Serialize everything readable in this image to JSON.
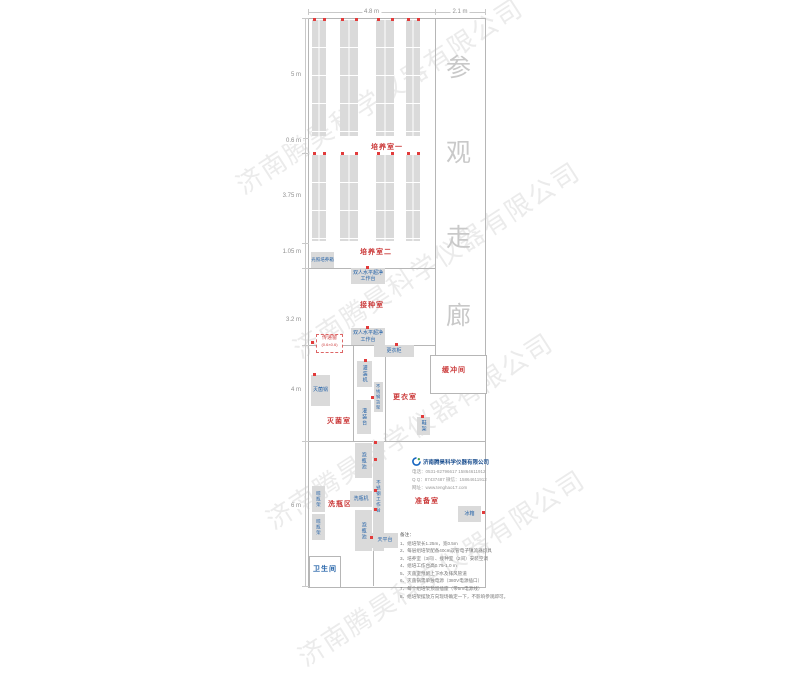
{
  "watermark": {
    "text": "济南腾昊科学仪器有限公司",
    "positions": [
      [
        238,
        168
      ],
      [
        295,
        332
      ],
      [
        268,
        503
      ],
      [
        300,
        640
      ]
    ]
  },
  "corridor": {
    "label": "参观走廊",
    "x": 446,
    "char_ys": [
      48,
      133,
      218,
      296
    ]
  },
  "dimensions": {
    "top": [
      {
        "label": "4.8 m",
        "x1": 308,
        "x2": 435
      },
      {
        "label": "2.1 m",
        "x1": 435,
        "x2": 485
      }
    ],
    "left": [
      {
        "label": "5 m",
        "y": 75
      },
      {
        "label": "0.6 m",
        "y": 141
      },
      {
        "label": "3.75 m",
        "y": 196
      },
      {
        "label": "1.05 m",
        "y": 252
      },
      {
        "label": "3.2 m",
        "y": 320
      },
      {
        "label": "4 m",
        "y": 390
      },
      {
        "label": "6 m",
        "y": 506
      }
    ],
    "tick_ys": [
      18,
      138,
      153,
      243,
      268,
      345,
      441,
      586
    ]
  },
  "plan": {
    "outline": [
      308,
      18,
      176,
      568
    ],
    "walls": [
      [
        435,
        18,
        1,
        337
      ],
      [
        308,
        268,
        128,
        1
      ],
      [
        308,
        345,
        128,
        1
      ],
      [
        308,
        441,
        177,
        1
      ],
      [
        353,
        345,
        1,
        96
      ],
      [
        385,
        345,
        1,
        96
      ],
      [
        373,
        548,
        1,
        38
      ]
    ],
    "room_boxes": [
      [
        430,
        355,
        55,
        37
      ],
      [
        309,
        556,
        30,
        30
      ]
    ],
    "racks": {
      "sections": [
        {
          "y": 20,
          "h": 116
        },
        {
          "y": 155,
          "h": 86
        }
      ],
      "strips": [
        {
          "x": 312,
          "w": 14
        },
        {
          "x": 340,
          "w": 18
        },
        {
          "x": 376,
          "w": 18
        },
        {
          "x": 406,
          "w": 14
        }
      ]
    }
  },
  "room_labels": [
    {
      "text": "培养室一",
      "x": 371,
      "y": 142,
      "color": "red"
    },
    {
      "text": "培养室二",
      "x": 360,
      "y": 247,
      "color": "red"
    },
    {
      "text": "接种室",
      "x": 360,
      "y": 300,
      "color": "red"
    },
    {
      "text": "灭菌室",
      "x": 327,
      "y": 416,
      "color": "red"
    },
    {
      "text": "更衣室",
      "x": 393,
      "y": 392,
      "color": "red"
    },
    {
      "text": "缓冲间",
      "x": 442,
      "y": 365,
      "color": "red"
    },
    {
      "text": "洗瓶区",
      "x": 328,
      "y": 499,
      "color": "red"
    },
    {
      "text": "准备室",
      "x": 415,
      "y": 496,
      "color": "red"
    },
    {
      "text": "卫生间",
      "x": 313,
      "y": 564,
      "color": "blue"
    }
  ],
  "pass_window": {
    "text": "传递窗",
    "sub": "(0.6×0.6)",
    "x": 316,
    "y": 334,
    "w": 25,
    "h": 17
  },
  "equipment": [
    {
      "text": "光照培养箱",
      "x": 311,
      "y": 252,
      "w": 23,
      "h": 16,
      "v": false,
      "fs": 4.5
    },
    {
      "text": "双人水平超净工作台",
      "x": 351,
      "y": 268,
      "w": 34,
      "h": 16,
      "v": false,
      "fs": 5
    },
    {
      "text": "双人水平超净工作台",
      "x": 351,
      "y": 328,
      "w": 34,
      "h": 17,
      "v": false,
      "fs": 5
    },
    {
      "text": "更衣柜",
      "x": 374,
      "y": 345,
      "w": 40,
      "h": 12,
      "v": false,
      "fs": 5
    },
    {
      "text": "灭菌锅",
      "x": 311,
      "y": 375,
      "w": 19,
      "h": 31,
      "v": false,
      "fs": 5
    },
    {
      "text": "灌装机",
      "x": 357,
      "y": 361,
      "w": 15,
      "h": 26,
      "v": true,
      "fs": 5
    },
    {
      "text": "不锈钢货架",
      "x": 374,
      "y": 382,
      "w": 9,
      "h": 30,
      "v": true,
      "fs": 4.2
    },
    {
      "text": "灌装台",
      "x": 357,
      "y": 400,
      "w": 14,
      "h": 34,
      "v": true,
      "fs": 5
    },
    {
      "text": "鞋架",
      "x": 417,
      "y": 417,
      "w": 13,
      "h": 18,
      "v": true,
      "fs": 5
    },
    {
      "text": "泡瓶池",
      "x": 355,
      "y": 443,
      "w": 17,
      "h": 35,
      "v": true,
      "fs": 5
    },
    {
      "text": "不锈钢工作台",
      "x": 373,
      "y": 441,
      "w": 11,
      "h": 110,
      "v": true,
      "fs": 4.5
    },
    {
      "text": "洗瓶机",
      "x": 350,
      "y": 491,
      "w": 22,
      "h": 16,
      "v": false,
      "fs": 5
    },
    {
      "text": "晾瓶架",
      "x": 312,
      "y": 486,
      "w": 13,
      "h": 26,
      "v": true,
      "fs": 4.5
    },
    {
      "text": "晾瓶架",
      "x": 312,
      "y": 514,
      "w": 13,
      "h": 26,
      "v": true,
      "fs": 4.5
    },
    {
      "text": "泡瓶池",
      "x": 355,
      "y": 510,
      "w": 17,
      "h": 41,
      "v": true,
      "fs": 5
    },
    {
      "text": "天平台",
      "x": 372,
      "y": 533,
      "w": 26,
      "h": 15,
      "v": false,
      "fs": 5
    },
    {
      "text": "冰箱",
      "x": 458,
      "y": 506,
      "w": 23,
      "h": 16,
      "v": false,
      "fs": 5
    }
  ],
  "outlets": [
    [
      313,
      18
    ],
    [
      323,
      18
    ],
    [
      341,
      18
    ],
    [
      355,
      18
    ],
    [
      377,
      18
    ],
    [
      391,
      18
    ],
    [
      407,
      18
    ],
    [
      417,
      18
    ],
    [
      313,
      152
    ],
    [
      323,
      152
    ],
    [
      341,
      152
    ],
    [
      355,
      152
    ],
    [
      377,
      152
    ],
    [
      391,
      152
    ],
    [
      407,
      152
    ],
    [
      417,
      152
    ],
    [
      366,
      266
    ],
    [
      366,
      326
    ],
    [
      311,
      341
    ],
    [
      395,
      343
    ],
    [
      313,
      373
    ],
    [
      364,
      359
    ],
    [
      371,
      396
    ],
    [
      374,
      441
    ],
    [
      374,
      458
    ],
    [
      374,
      489
    ],
    [
      374,
      508
    ],
    [
      370,
      536
    ],
    [
      482,
      511
    ],
    [
      421,
      415
    ]
  ],
  "logo": {
    "company": "济南腾昊科学仪器有限公司",
    "lines": [
      "电话：0531-82796617  15864611912",
      "Q Q：87437487    微信：15864611912",
      "网址：www.tenghao17.com"
    ]
  },
  "notes": {
    "heading": "备注：",
    "items": [
      "1、组培架长1.25m，宽0.5m",
      "2、每层组培架配备40cm双管电子镇流器灯具",
      "3、培养室（3间）、接种室（2间）安装空调",
      "4、组培工作台高0.75-1.0 m",
      "5、灭菌室预留上下水及排风管道",
      "6、灭菌锅需单独电源（380V电源插口）",
      "7、每个组培架预留插座（带5m电源线）",
      "8、组培架摆放方向现场确定一下，不影响参观即可。"
    ]
  }
}
